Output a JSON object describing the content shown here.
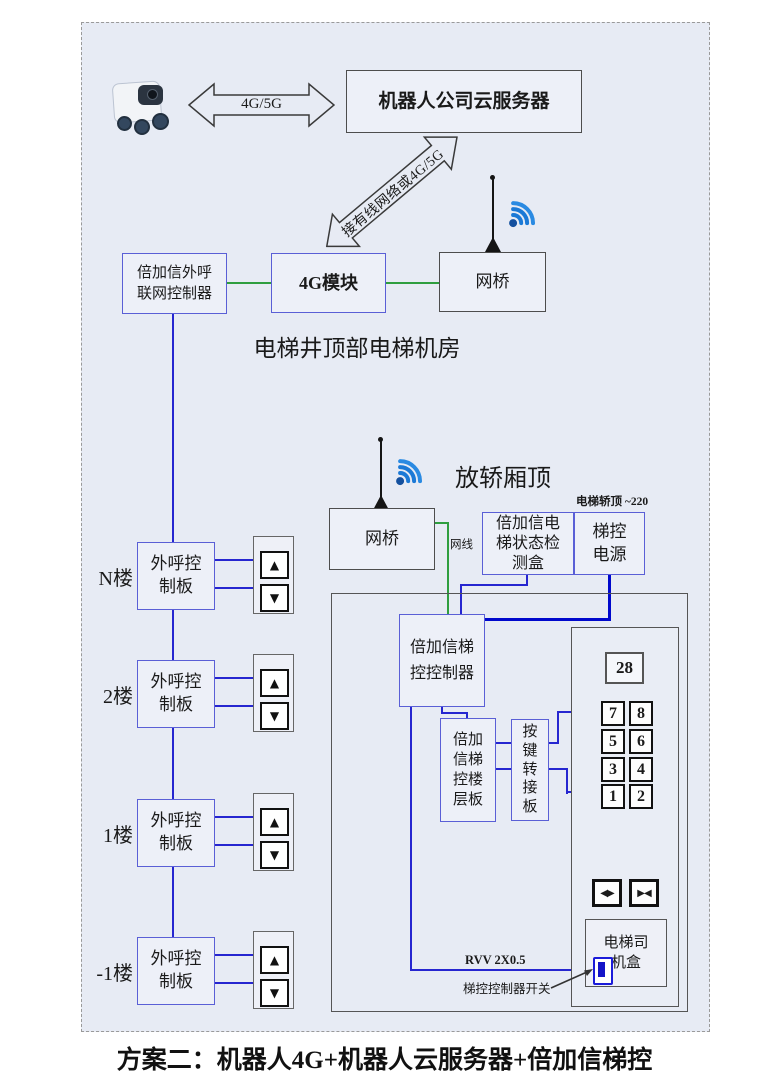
{
  "caption": "方案二：机器人4G+机器人云服务器+倍加信梯控",
  "top": {
    "robot_arrow_label": "4G/5G",
    "cloud_server": "机器人公司云服务器",
    "diagonal_arrow_label": "接有线网络或4G/5G"
  },
  "machine_room": {
    "outcall_controller": "倍加信外呼\n联网控制器",
    "module_4g": "4G模块",
    "bridge": "网桥",
    "caption": "电梯井顶部电梯机房"
  },
  "car_top": {
    "title": "放轿厢顶",
    "bridge": "网桥",
    "cable_label": "网线",
    "status_box": "倍加信电\n梯状态检\n测盒",
    "power": "梯控\n电源",
    "power_note": "电梯轿顶 ~220"
  },
  "car": {
    "controller": "倍加信梯\n控控制器",
    "floor_board": "倍加\n信梯\n控楼\n层板",
    "key_adapter": "按\n键\n转\n接\n板",
    "display": "28",
    "keypad": [
      "7",
      "8",
      "5",
      "6",
      "3",
      "4",
      "1",
      "2"
    ],
    "driver_box": "电梯司\n机盒",
    "rvv_label": "RVV 2X0.5",
    "switch_label": "梯控控制器开关"
  },
  "floors": [
    {
      "label": "N楼",
      "board": "外呼控\n制板"
    },
    {
      "label": "2楼",
      "board": "外呼控\n制板"
    },
    {
      "label": "1楼",
      "board": "外呼控\n制板"
    },
    {
      "label": "-1楼",
      "board": "外呼控\n制板"
    }
  ],
  "icons": {
    "up": "▲",
    "down": "▼",
    "door_open": "◀▶",
    "door_close": "▶◀"
  },
  "colors": {
    "panel_bg": "#e7ebf4",
    "box_border_blue": "#5a5fd6",
    "wire_blue": "#2626d0",
    "power_blue": "#0008cc",
    "wire_green": "#2f9e3f",
    "gray_border": "#4d4d4d",
    "wifi_blue": "#1b79d6"
  }
}
